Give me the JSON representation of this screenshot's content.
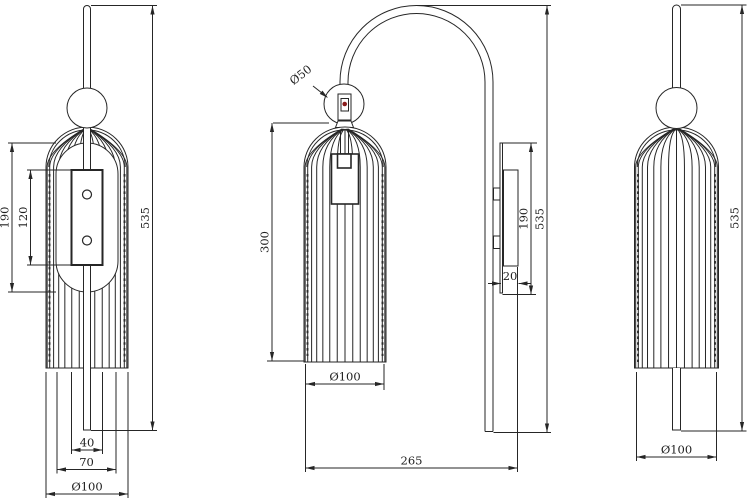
{
  "drawing": {
    "title": "wall-lamp-technical-drawing",
    "background": "#ffffff",
    "stroke_color": "#262626",
    "text_color": "#1f1f1f",
    "accent_red": "#8a1c1c",
    "views": [
      {
        "name": "front-view",
        "dims": [
          {
            "label": "190"
          },
          {
            "label": "120"
          },
          {
            "label": "535"
          },
          {
            "label": "40"
          },
          {
            "label": "70"
          },
          {
            "label": "Ø100"
          }
        ]
      },
      {
        "name": "side-view",
        "dims": [
          {
            "label": "Ø50"
          },
          {
            "label": "300"
          },
          {
            "label": "535"
          },
          {
            "label": "190"
          },
          {
            "label": "20"
          },
          {
            "label": "Ø100"
          },
          {
            "label": "265"
          }
        ]
      },
      {
        "name": "back-view",
        "dims": [
          {
            "label": "535"
          },
          {
            "label": "Ø100"
          }
        ]
      }
    ]
  }
}
